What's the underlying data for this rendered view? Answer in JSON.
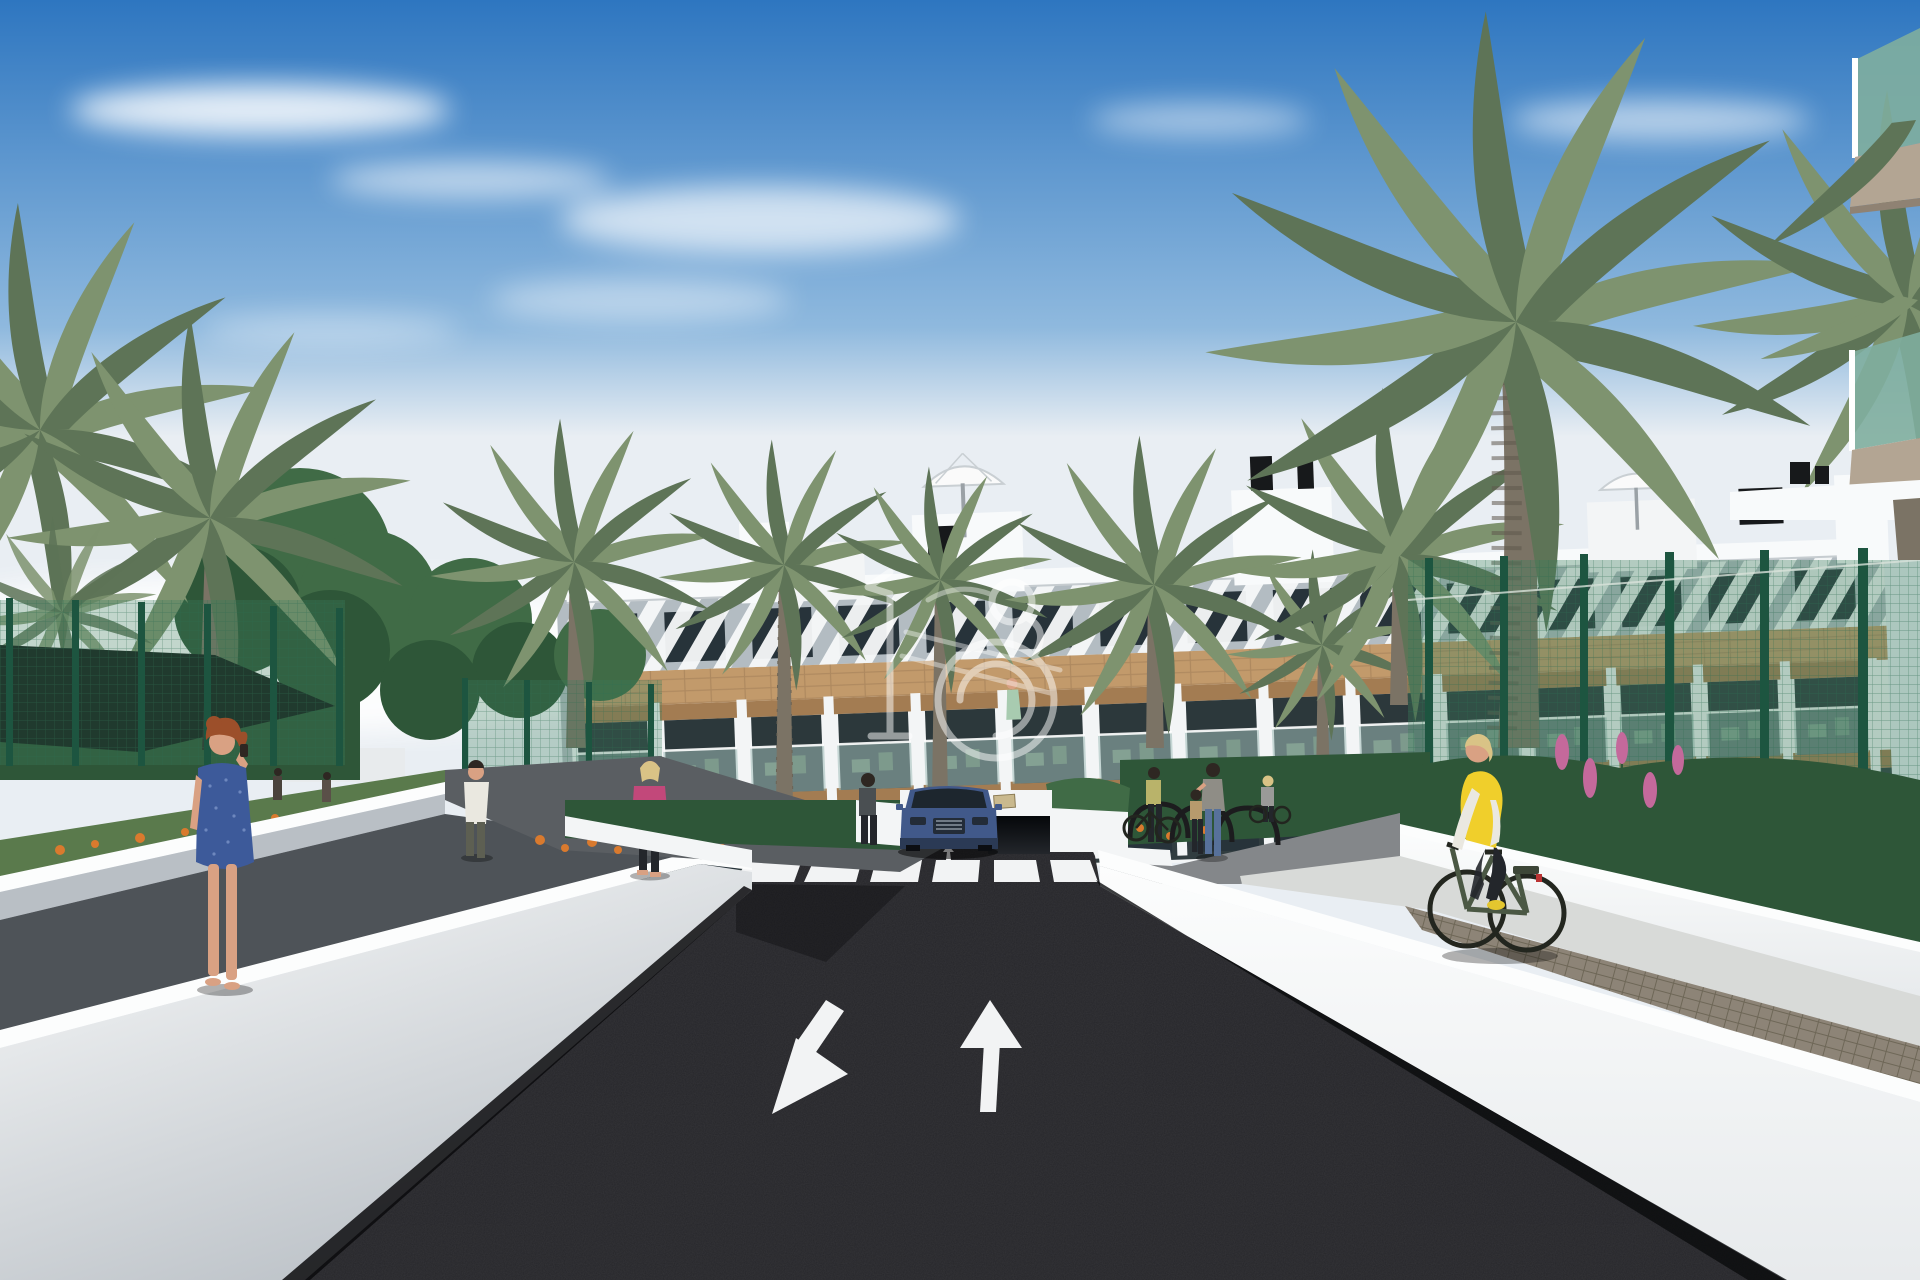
{
  "meta": {
    "domain": "natural-image",
    "description": "3D architectural rendering: street view of a modern white three-storey apartment complex with wood cladding bands, balconies, rooftop terraces, palm trees, a dark asphalt road with zebra crossing and direction arrows, a blue SUV leaving an underground garage, pedestrians and a cyclist, under a blue sky with wispy clouds. A white line-art logo watermark sits at the centre.",
    "canvas": {
      "width": 1920,
      "height": 1280
    },
    "visible_text": "none"
  },
  "scene": {
    "colors": {
      "sky_top": "#2e76c0",
      "sky_mid": "#8fb9de",
      "sky_horizon": "#e9eef3",
      "cloud": "#ffffff",
      "building_white": "#f3f5f6",
      "parapet_white": "#f8fafb",
      "fascia_shade": "#b3bcc2",
      "wood": "#c29a6b",
      "wood_dark": "#a37c52",
      "window_dark": "#27333a",
      "balcony_dark": "#2c383b",
      "glass_pane": "#9fbcb8",
      "roof_item_dark": "#17191b",
      "asphalt": "#26262a",
      "marking_white": "#f2f3f4",
      "wall_bright": "#fcfdfd",
      "wall_face": "#e7eaec",
      "wall_shade": "#b9bfc5",
      "walkway_dark": "#4e5358",
      "path_grey": "#84878a",
      "pavement": "#d8dad8",
      "paver": "#8d8477",
      "fence_post": "#1d5540",
      "mesh_green": "#3c7f5c",
      "palm": "#7e936f",
      "palm_dark": "#5e7457",
      "palm_trunk": "#7b7365",
      "tree": "#406b46",
      "tree_dark": "#2e5638",
      "grass": "#5a7a4c",
      "flower_orange": "#d97a2e",
      "flower_pink": "#c4699b",
      "car_blue": "#41598a",
      "car_dark": "#232c38",
      "skin": "#d9a183",
      "hair_red": "#9c4f2a",
      "hair_blonde": "#d9c386",
      "hair_dark": "#2e2722",
      "dress_blue": "#3d5a9a",
      "jacket_pink": "#c2487a",
      "shirt_white": "#eae8e0",
      "vest_yellow": "#f0cf2b",
      "pants_dark": "#23262b",
      "bike_green": "#4b5844",
      "bag_brown": "#8a6a4a",
      "canopy_dark": "#151d1a",
      "watermark": "#ffffff"
    },
    "sky": {
      "condition": "sunny with wispy cirrus clouds",
      "gradient": [
        "sky_top",
        "sky_mid",
        "sky_horizon"
      ]
    },
    "building": {
      "label": "white apartment block",
      "stories": 3,
      "features": [
        "white angled-slat pergola band along roofline",
        "wood cladding bands between floors",
        "balconies with wooden pergolas and tinted glass balustrades",
        "green outdoor furniture on balconies",
        "rooftop stair towers, white parasols and black chimney vents",
        "underground garage entrance at street level"
      ]
    },
    "road": {
      "surface": "dark asphalt",
      "markings": [
        "zebra crossing with 6 white stripes",
        "small exit arrow toward viewer",
        "small entry arrow away from viewer",
        "large white arrow pointing toward viewer (left lane)",
        "large white arrow pointing away from viewer (right lane)"
      ]
    },
    "vehicle": {
      "type": "blue SUV exiting underground garage, facing viewer"
    },
    "people": [
      {
        "id": "woman-blue-dress",
        "desc": "red-haired woman in blue patterned dress talking on phone, left walkway foreground"
      },
      {
        "id": "woman-pink-jacket",
        "desc": "blonde woman in pink jacket, black trousers, brown handbag, on left path"
      },
      {
        "id": "man-white-shirt",
        "desc": "man in white t-shirt and olive trousers walking away on left path"
      },
      {
        "id": "woman-dark-top",
        "desc": "woman standing left of the garage ramp"
      },
      {
        "id": "person-with-bike",
        "desc": "person in olive top beside bicycle at the racks"
      },
      {
        "id": "mother-and-child",
        "desc": "dark-haired woman in jeans touching head of small child near bike racks"
      },
      {
        "id": "woman-pushing-bike",
        "desc": "woman in grey top with bicycle further right"
      },
      {
        "id": "cyclist-yellow-vest",
        "desc": "blonde cyclist in yellow vest, white sleeves, black leggings on a green city bike, right pavement"
      },
      {
        "id": "balcony-figure",
        "desc": "figure in mint dress standing on first-floor balcony"
      },
      {
        "id": "distant-couple",
        "desc": "two small figures near the left sports-court fence"
      }
    ],
    "street_furniture": [
      "black hoop bike racks",
      "tall green mesh sport-court fences on both sides",
      "dark shade canopy at far left",
      "white retaining walls and planters lining the road",
      "grey paved pedestrian walkways"
    ],
    "vegetation": [
      "large date palms on both sides and in front of facade",
      "round leafy trees at left",
      "small fan palm at far left",
      "flower beds with orange blooms along left path",
      "pink flower spikes behind right fence",
      "green shrub planters at right"
    ],
    "watermark": {
      "desc": "semi-transparent white line-art emblem centred on the facade",
      "opacity": 0.5
    }
  }
}
